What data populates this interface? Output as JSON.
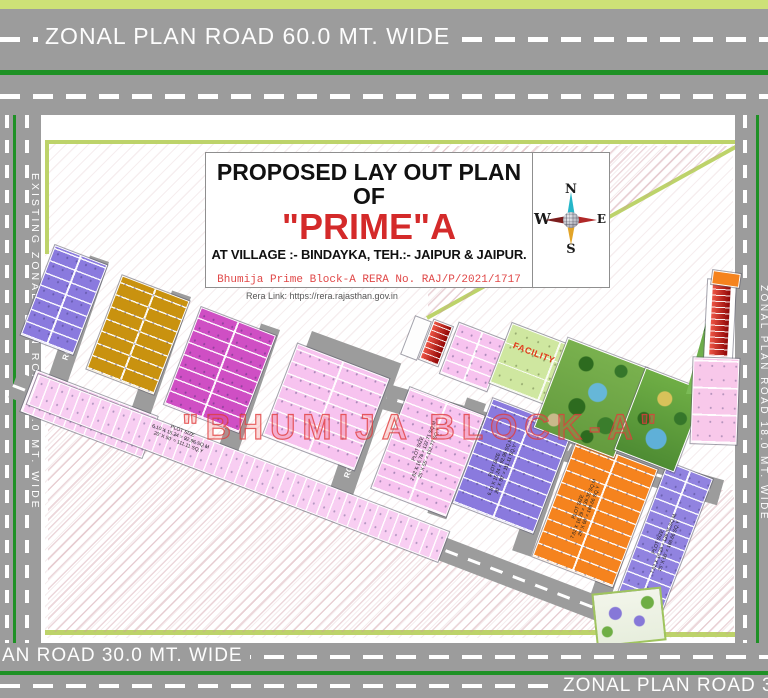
{
  "roads": {
    "top": "ZONAL PLAN ROAD 60.0 MT. WIDE",
    "left": "EXISTING ZONAL PLAN ROAD 18.0 MT. WIDE",
    "right": "ZONAL PLAN ROAD 18.0 MT. WIDE",
    "bottom_a": "AN ROAD 30.0 MT. WIDE",
    "bottom_b": "ZONAL PLAN ROAD 30.0 M",
    "r12": "ROAD 12.0 MT. WIDE",
    "r9": "ROAD 9.0 MT. WIDE"
  },
  "title_block": {
    "line1": "PROPOSED LAY OUT PLAN OF",
    "line2": "\"PRIME\"A",
    "line3": "AT VILLAGE :- BINDAYKA, TEH.:- JAIPUR & JAIPUR.",
    "rera_line": "Bhumija Prime Block-A RERA No.  RAJ/P/2021/1717",
    "rera_link": "Rera Link: https://rera.rajasthan.gov.in"
  },
  "compass": {
    "n": "N",
    "e": "E",
    "s": "S",
    "w": "W"
  },
  "watermark": "\"BHUMIJA BLOCK-A\"",
  "facility_label": "FACILITY",
  "ann": {
    "d": [
      "PLOT SIZE",
      "6.10 X 15.24 = 92.96 SQ.M",
      "20' X 50' = 111.11 SQ.Y"
    ],
    "f": [
      "PLOT SIZE",
      "7.62 X 16.76 = 127.71 SQ.M",
      "25' X 55' = 152.77 SQ.Y"
    ],
    "g": [
      "PLOT SIZE",
      "6.10 X 15.24 = 92.96 SQ.M",
      "20' X 50' = 111.11 SQ.Y"
    ],
    "h": [
      "PLOT SIZE",
      "7.62 X 18.29 = 139.35 SQ.M",
      "25' X 60' = 166.66 SQ.Y"
    ],
    "i": [
      "PLOT SIZE",
      "7.62 X 18.29 = 139.35 SQ.M",
      "25' X 60' = 166.66 SQ.Y"
    ]
  },
  "colors": {
    "road_gray": "#9c9c9c",
    "divider_green": "#1e9125",
    "boundary_olive": "#bdd36a",
    "edge_strip_green": "#cde177",
    "block_purple": "#8a7ade",
    "block_gold": "#c9920f",
    "block_magenta": "#cf4fc4",
    "block_pink": "#f7c3ef",
    "block_orange": "#f5831e",
    "facility_green": "#cfe7a0",
    "park_green": "#79b14e",
    "commercial_red": "#c01818",
    "title_red": "#d42a2a",
    "watermark_red": "#e04848"
  }
}
